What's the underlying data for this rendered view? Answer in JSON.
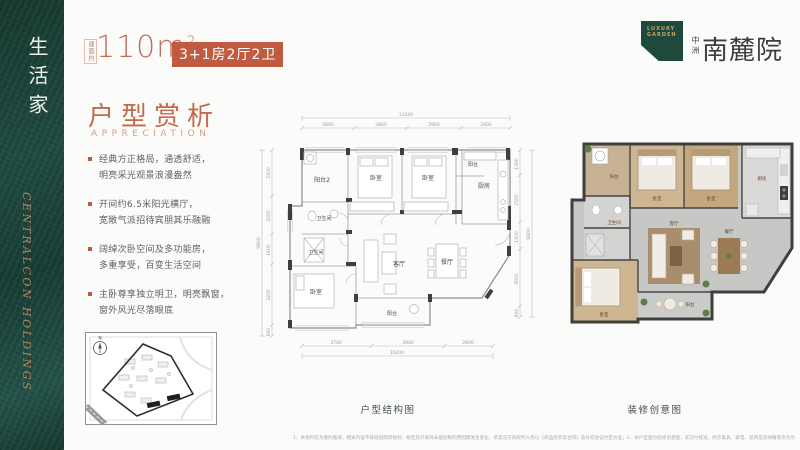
{
  "sidebar": {
    "vertical_title": "生活家",
    "script_text": "CENTRALCON HOLDINGS"
  },
  "header": {
    "area_label": "建面约",
    "area_value": "110m",
    "area_sup": "2",
    "badge": "3+1房2厅2卫"
  },
  "logo": {
    "tagline_line1": "LUXURY",
    "tagline_line2": "GARDEN",
    "brand_prefix": "中洲",
    "brand_name": "南麓院"
  },
  "section": {
    "title": "户型赏析",
    "subtitle": "APPRECIATION"
  },
  "bullets": [
    {
      "line1": "经典方正格局，通透舒适，",
      "line2": "明亮采光观景浪漫盎然"
    },
    {
      "line1": "开间约6.5米阳光横厅，",
      "line2": "宽敞气派招待宾朋其乐融融"
    },
    {
      "line1": "阔绰次卧空间及多功能房，",
      "line2": "多重享受，百变生活空间"
    },
    {
      "line1": "主卧尊享独立明卫，明亮飘窗，",
      "line2": "窗外风光尽落眼底"
    }
  ],
  "structure_plan": {
    "caption": "户型结构图",
    "dims": {
      "top_total": "11100",
      "top": [
        "2800",
        "2800",
        "2900",
        "2600"
      ],
      "bottom_total": "10200",
      "bottom": [
        "3700",
        "3900",
        "2600"
      ],
      "left_total": "9800",
      "left": [
        "2400",
        "2000",
        "1600",
        "3200",
        "600"
      ],
      "right_total": "8800",
      "right": [
        "1300",
        "2500",
        "1400",
        "3000",
        "600"
      ]
    },
    "rooms": [
      "阳台2",
      "卧室",
      "卧室",
      "阳台",
      "厨房",
      "卫生间",
      "卫生间",
      "卧室",
      "客厅",
      "餐厅",
      "阳台"
    ]
  },
  "creative_plan": {
    "caption": "装修创意图",
    "rooms": [
      "阳台",
      "卧室",
      "卧室",
      "厨房",
      "卫生间",
      "卧室",
      "客厅",
      "餐厅",
      "阳台"
    ]
  },
  "site_map": {
    "north_label": "N"
  },
  "footer": {
    "disclaimer": "1、本资料仅为要约邀请，相关内容不排除因政府规划、规定及开发商未能控制的原因而发生变化，买卖双方的权利义务以《商品房买卖合同》及补充协议约定为准；2、本户型图为装修创意图，非交付标准，所示家具、家电、装饰品及绿植等仅为示意参考，不属于交付范围，产品信息以政府批文为准；3、本资料制作时间有限，相关信息敬请留意最新资料，开发商在法律允许范围内保留解释权。"
  }
}
